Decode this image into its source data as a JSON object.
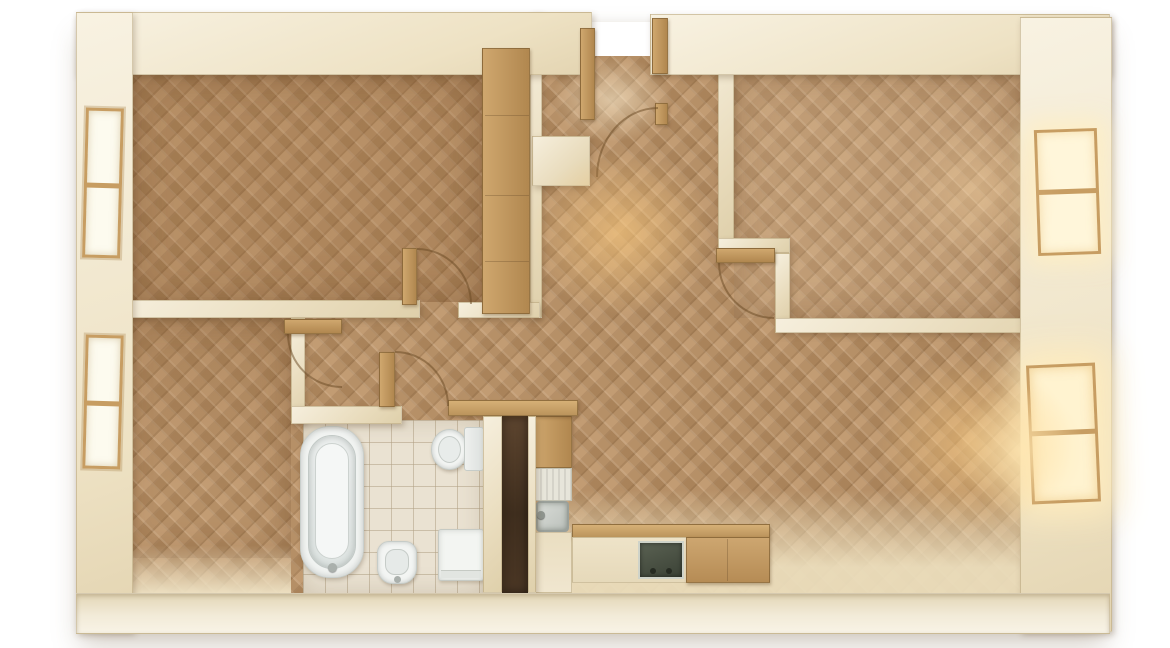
{
  "meta": {
    "type": "3d-floor-plan-render",
    "view": "top-down",
    "description": "Photorealistic top-down 3D render of an apartment floor plan: cream walls, herringbone parquet floors, warm interior lighting, four windows, bathroom and kitchen fixtures, open wooden doors with swing arcs"
  },
  "palette": {
    "background": "#ffffff",
    "wall": "#eee3c8",
    "wall_edge": "#c6b48e",
    "floor_parquet": "#bc9164",
    "floor_tile": "#eae2d2",
    "wood_trim": "#c49c63",
    "fixture_white": "#f3f5f2",
    "cooktop_dark": "#474f41",
    "niche_shadow": "#46342a",
    "light_glow": "#ffce82",
    "window_glass": "#fdfbef",
    "window_glass_lit": "#fff6da"
  },
  "rooms": [
    {
      "id": "bedroom-top-left",
      "name": "Bedroom (top left)",
      "floor": "herringbone parquet"
    },
    {
      "id": "bedroom-bottom-left",
      "name": "Bedroom (bottom left)",
      "floor": "herringbone parquet"
    },
    {
      "id": "room-top-right",
      "name": "Room (top right)",
      "floor": "herringbone parquet"
    },
    {
      "id": "living-kitchen",
      "name": "Living room with kitchen (bottom right)",
      "floor": "herringbone parquet"
    },
    {
      "id": "hallway",
      "name": "Hallway",
      "floor": "herringbone parquet"
    },
    {
      "id": "vestibule",
      "name": "Entry vestibule",
      "floor": "herringbone parquet"
    },
    {
      "id": "bathroom",
      "name": "Bathroom",
      "floor": "ceramic tile"
    },
    {
      "id": "storage-niche",
      "name": "Storage niche",
      "floor": "shadowed"
    }
  ],
  "fixtures": [
    {
      "id": "bathtub",
      "name": "Bathtub"
    },
    {
      "id": "toilet",
      "name": "Toilet"
    },
    {
      "id": "bidet",
      "name": "Bidet"
    },
    {
      "id": "washing-machine",
      "name": "Washing machine"
    },
    {
      "id": "kitchen-sink",
      "name": "Kitchen sink with drainboard"
    },
    {
      "id": "cooktop",
      "name": "Cooktop"
    },
    {
      "id": "kitchen-cabinet",
      "name": "Kitchen cabinet"
    },
    {
      "id": "wardrobe",
      "name": "Built-in wardrobe"
    }
  ],
  "openings": {
    "entrance": {
      "name": "Main entrance (top wall, doors open)"
    },
    "windows": [
      {
        "id": "window-left-top",
        "wall": "left",
        "position": "upper",
        "lit": false
      },
      {
        "id": "window-left-bottom",
        "wall": "left",
        "position": "lower",
        "lit": false
      },
      {
        "id": "window-right-top",
        "wall": "right",
        "position": "upper",
        "lit": true
      },
      {
        "id": "window-right-bottom",
        "wall": "right",
        "position": "lower",
        "lit": true
      }
    ],
    "doors": [
      {
        "id": "door-bedroom-top-left",
        "state": "open"
      },
      {
        "id": "door-bedroom-bottom-left",
        "state": "open"
      },
      {
        "id": "door-bathroom",
        "state": "open"
      },
      {
        "id": "door-room-top-right",
        "state": "open"
      },
      {
        "id": "door-entry",
        "state": "open"
      }
    ]
  },
  "lighting": {
    "hall_glow": "warm light pool in hallway",
    "living_glow": "warm light pool near lower-right window",
    "window_light": "bright daylight through right-side windows"
  }
}
